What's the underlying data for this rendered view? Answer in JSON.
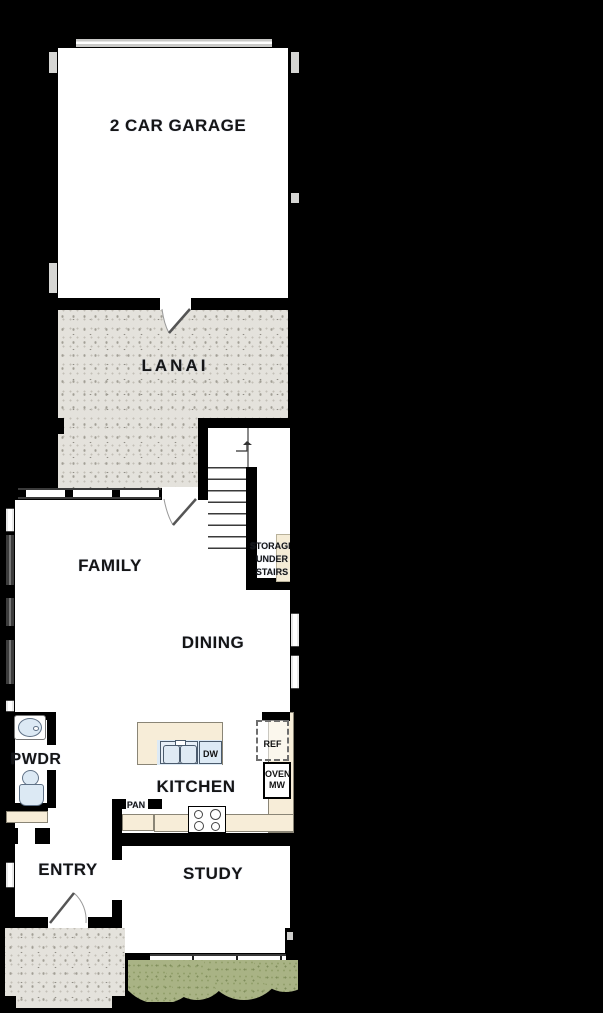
{
  "floorplan": {
    "rooms": {
      "garage": {
        "label": "2 CAR GARAGE"
      },
      "lanai": {
        "label": "LANAI"
      },
      "family": {
        "label": "FAMILY"
      },
      "dining": {
        "label": "DINING"
      },
      "powder": {
        "label": "PWDR"
      },
      "kitchen": {
        "label": "KITCHEN"
      },
      "entry": {
        "label": "ENTRY"
      },
      "study": {
        "label": "STUDY"
      }
    },
    "features": {
      "storage_line1": "STORAGE",
      "storage_line2": "UNDER",
      "storage_line3": "STAIRS",
      "dishwasher": "DW",
      "refrigerator": "REF",
      "oven": "OVEN",
      "microwave": "MW",
      "pantry": "PAN"
    },
    "colors": {
      "background": "#000000",
      "wall": "#000000",
      "floor": "#ffffff",
      "patio_texture": "#e4e2dc",
      "counter": "#f7edd8",
      "fixture_blue": "#dce9f4",
      "shrub_green": "#a9b385",
      "garage_door": "#c9c9c7"
    }
  }
}
